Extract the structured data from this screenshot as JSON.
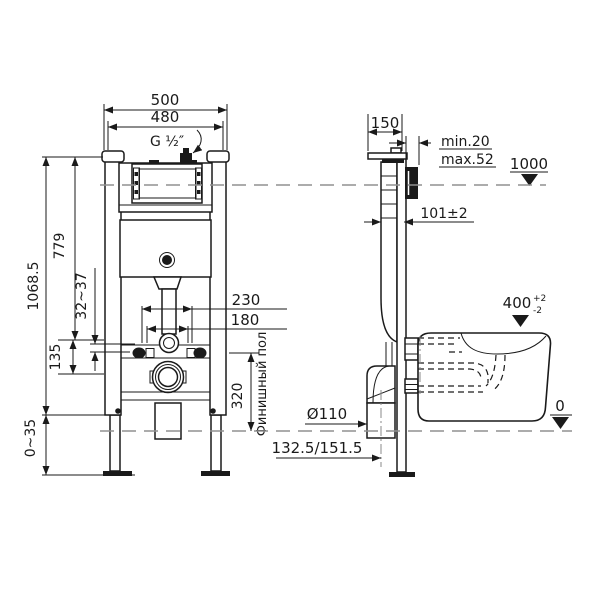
{
  "drawing": {
    "kind": "installation-dimension-drawing",
    "views": [
      "front",
      "side"
    ]
  },
  "front": {
    "dim_outer_width": "500",
    "dim_inner_width": "480",
    "inlet_thread": "G ½″",
    "dim_total_height": "1068.5",
    "dim_flush_height": "779",
    "dim_bracket_range": "32~37",
    "dim_pipe_gap": "135",
    "dim_leg_range": "0~35",
    "dim_stud_wide": "230",
    "dim_stud_narrow": "180",
    "dim_outlet_height": "320",
    "floor_label": "Финишный пол"
  },
  "side": {
    "dim_depth": "150",
    "wall_min": "min.20",
    "wall_max": "max.52",
    "dim_level": "1000",
    "dim_frame_depth": "101±2",
    "dim_bowl_height": "400",
    "bowl_tol_plus": "+2",
    "bowl_tol_minus": "-2",
    "dim_drain_dia": "Ø110",
    "dim_drain_offset": "132.5/151.5",
    "floor_zero": "0"
  },
  "colors": {
    "line": "#1a1a1a",
    "centerline": "#909090",
    "background": "#ffffff"
  }
}
